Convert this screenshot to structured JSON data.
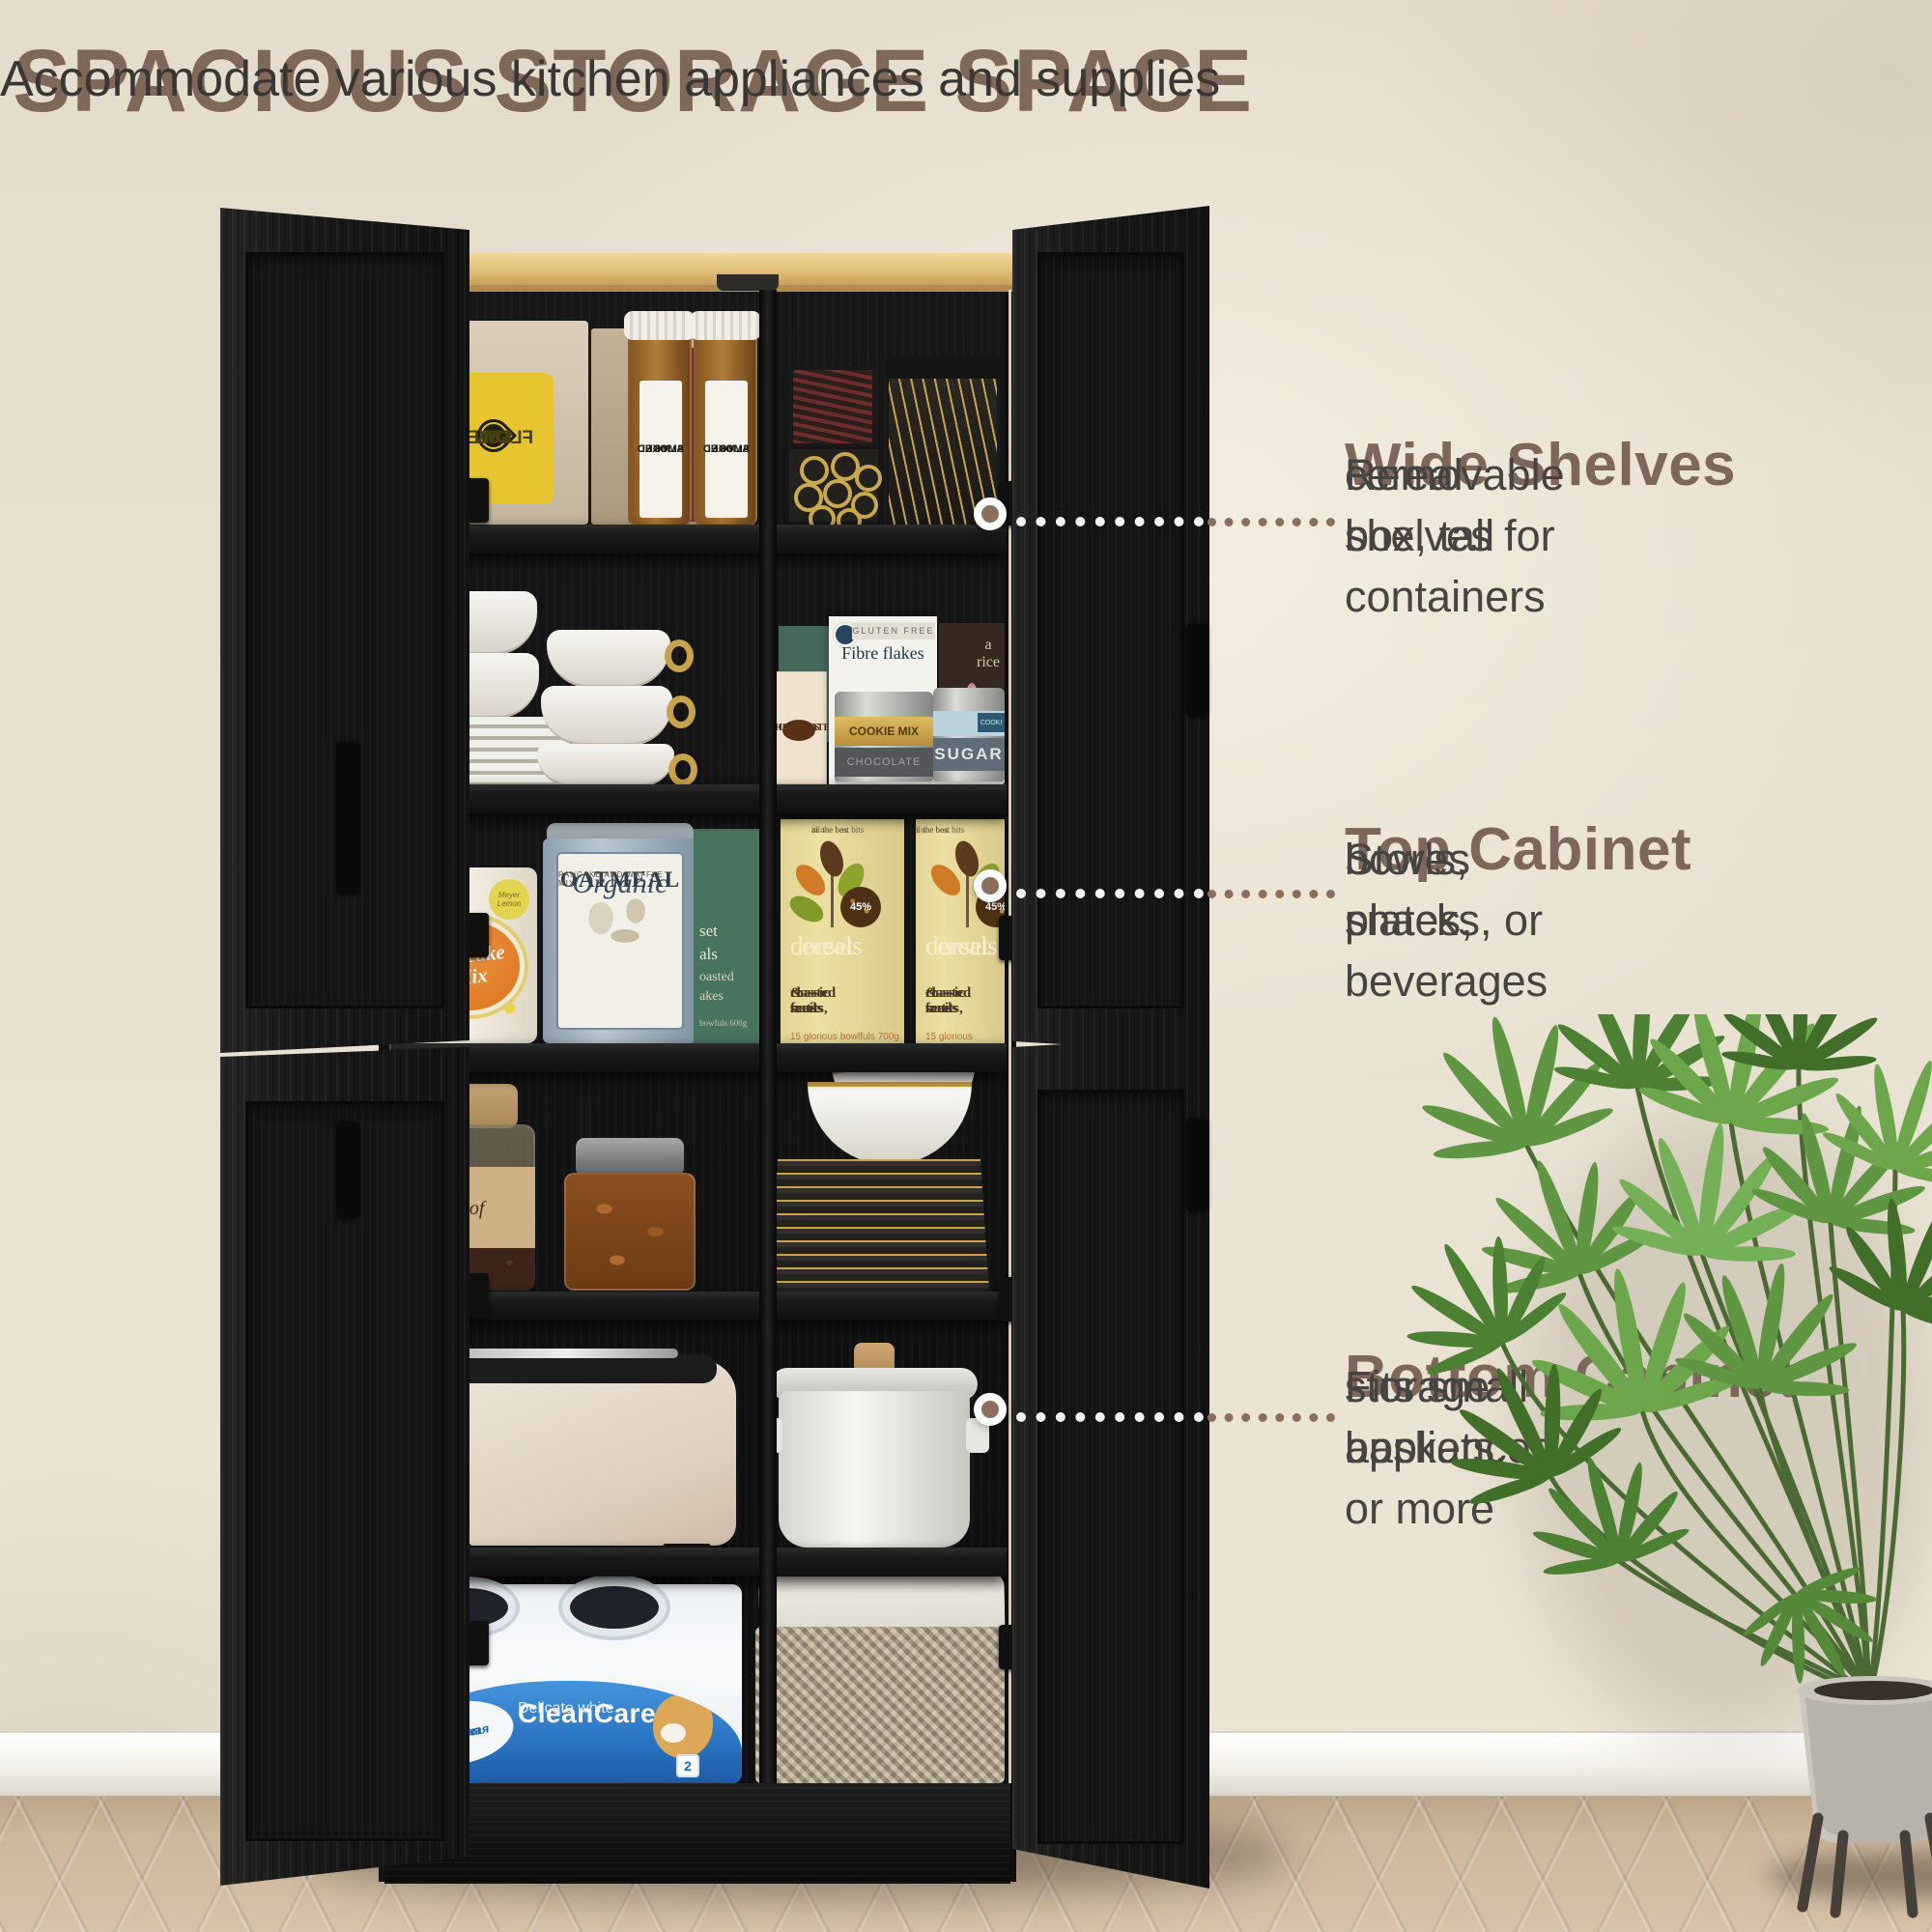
{
  "colors": {
    "heading_brown": "#7e685a",
    "body_text": "#3a3733",
    "callout_title": "#7c675a",
    "callout_text": "#474440",
    "dot_brown": "#8a6f5c",
    "wall_cream": "#e9e2d3",
    "floor_tan": "#cdb79c",
    "wood_top": "#e2c078",
    "cabinet_black": "#181818",
    "cleancare_blue": "#2a74c2",
    "dorset_yellow": "#ece0a2",
    "plant_green": "#5d9342",
    "pot_gray": "#b7b3aa"
  },
  "header": {
    "title": "SPACIOUS STORAGE SPACE",
    "subtitle": "Accommodate various kitchen appliances and supplies"
  },
  "callouts": [
    {
      "title": "Wide Shelves",
      "line1": "Removable shelves for",
      "line2": "cereal box, tall containers"
    },
    {
      "title": "Top Cabinet",
      "line1": "Stores plates,",
      "line2": "bowls, snacks, or beverages"
    },
    {
      "title": "Bottom Cabinet",
      "line1": "Fits small appliances,",
      "line2": "storage baskets, or more"
    }
  ],
  "products": {
    "sunflower": {
      "l1": "SUN",
      "l2": "FLOWER",
      "l3": "OIL"
    },
    "coconut": {
      "l1": "CO",
      "l2": "UT",
      "l3": "OIL"
    },
    "almond": {
      "l1": "SMOKED",
      "l2": "ALMOND",
      "l3": "03"
    },
    "chocolate": {
      "l1": "MILK",
      "l2": "CHOCOLATE",
      "l3": "CHUNKS"
    },
    "fibre": {
      "top": "GLUTEN FREE",
      "name": "Fibre flakes"
    },
    "rice": {
      "name": "a rice"
    },
    "cookie_tin": {
      "name": "COOKIE MIX",
      "band": "CHOCOLATE"
    },
    "sugar_tin": {
      "name": "SUGAR",
      "tab": "COOKI"
    },
    "cupcake": {
      "name": "Cupcake Mix",
      "badge": "Meyer Lemon"
    },
    "oatmeal": {
      "script": "Organic",
      "name": "OATMEAL",
      "sub": "PANCAKE AND WAFFLE MIX"
    },
    "dorset_green": {
      "f1": "set",
      "f2": "als",
      "f3": "oasted",
      "f4": "akes",
      "sub": "bowfuls 600g"
    },
    "dorset": {
      "top1": "all the best bits",
      "top2": "in one box",
      "badge": "45%",
      "name1": "dorset",
      "name2": "cereals",
      "d1": "classic fruits,",
      "d2": "roasted nuts",
      "d3": "& seeds",
      "sub": "15 glorious bowlfuls 700g"
    },
    "coffee": {
      "name": "Cof"
    },
    "cleancare": {
      "name": "CleanCare",
      "sub": "Delicate white",
      "badge1": "Мягкая",
      "badge2": "и прочная",
      "count1": "4",
      "count2": "2"
    }
  }
}
